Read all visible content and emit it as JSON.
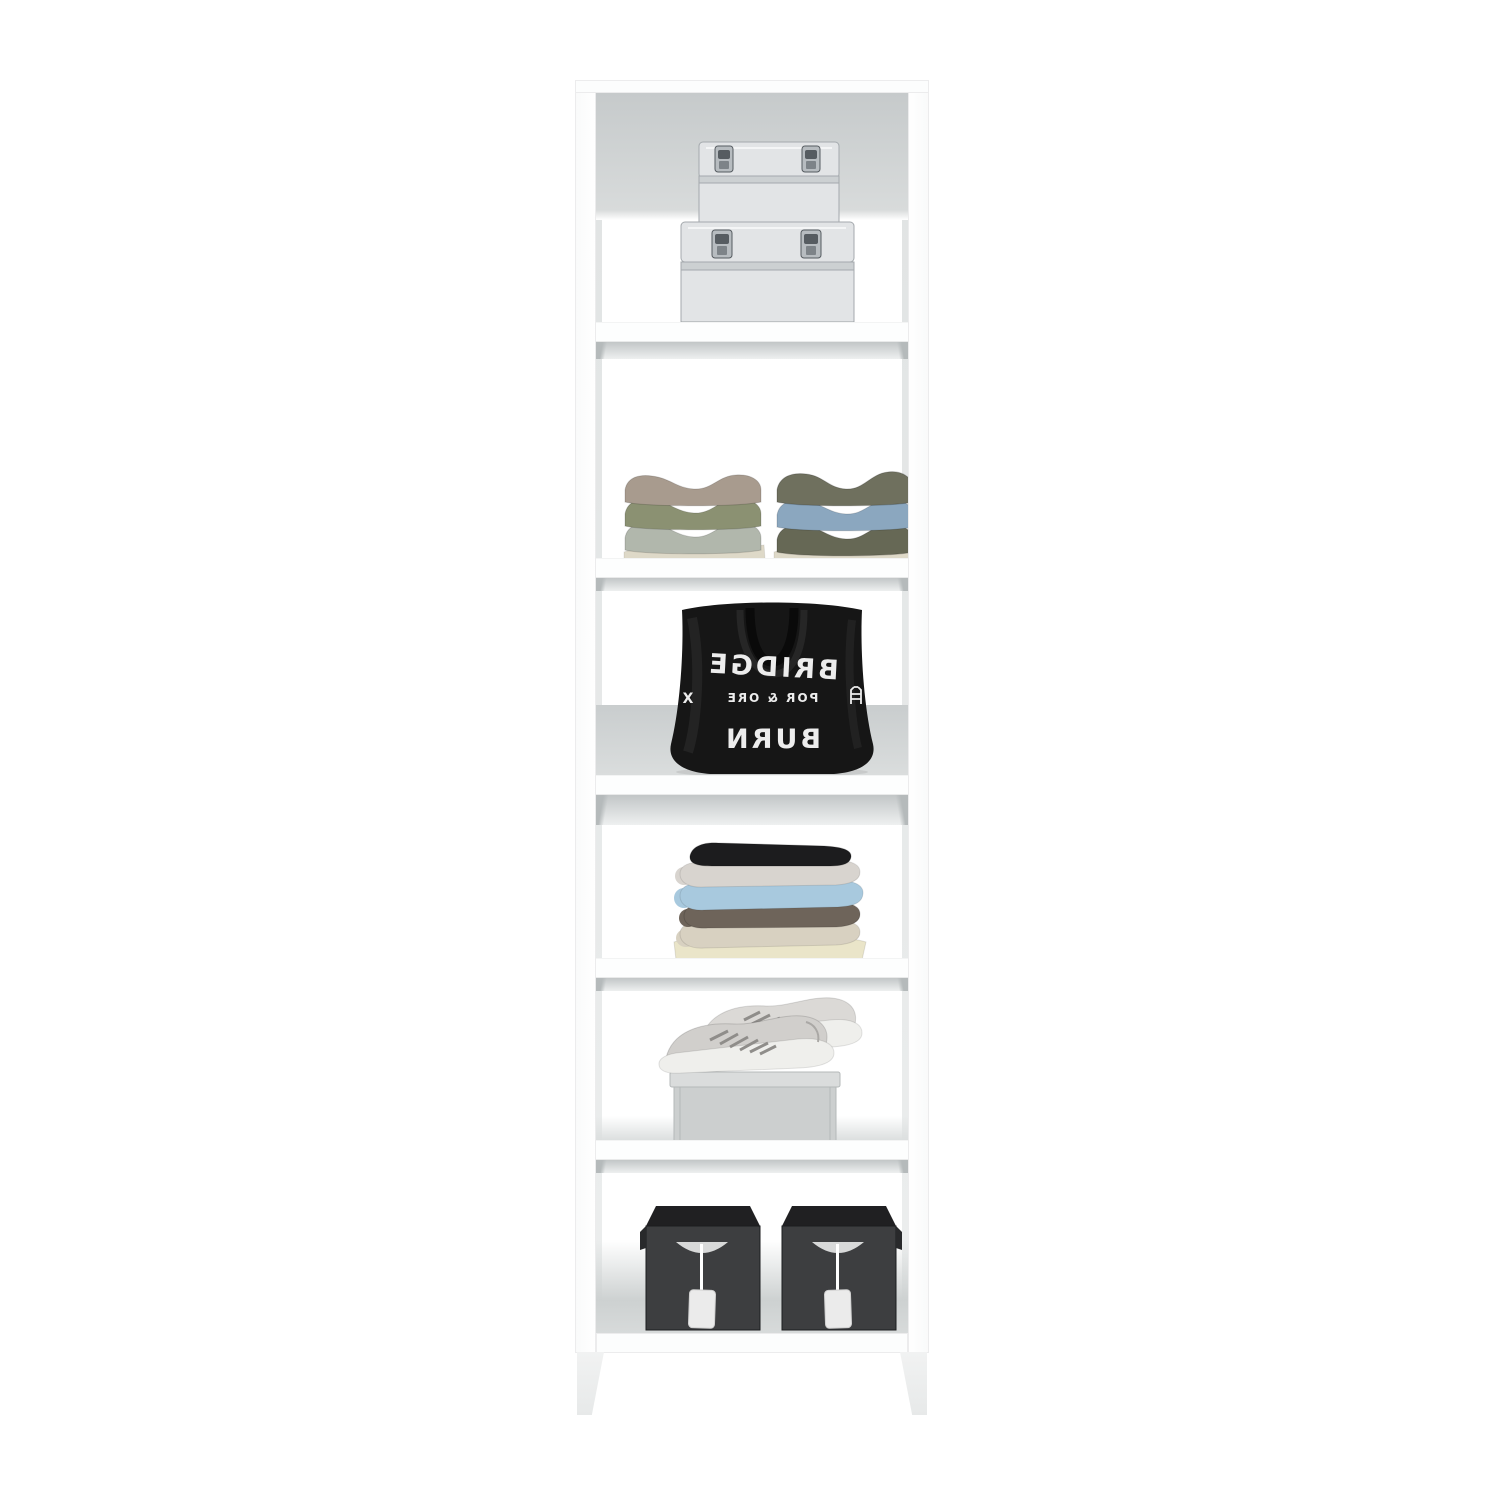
{
  "scene": {
    "background": "#ffffff",
    "subject": "white six-compartment closet tower, styled product photo",
    "compartment_count": 6,
    "leg_count": 2
  },
  "colors": {
    "frame_white": "#fdfdfd",
    "inner_face_gray": "#e7e9e9",
    "back_panel_gray": "#cdd1d2",
    "shelf_shadow_gray": "#c6cacb",
    "cases": {
      "shell": "#e2e4e6",
      "lip": "#ccd0d2",
      "outline": "#a4a9ad",
      "latch": "#b7bcc0",
      "latch_dark": "#565c61",
      "shadow": "#9aa0a3"
    },
    "sweaters_left": [
      "#a89b8e",
      "#8b9172",
      "#b1b7ac",
      "#ded9c8"
    ],
    "sweaters_right": [
      "#6f705e",
      "#8ba7bf",
      "#666855",
      "#ded9c8"
    ],
    "tote": {
      "body": "#161616",
      "handle": "#0a0a0a",
      "handle_front": "#262626",
      "print": "#ededed"
    },
    "clothes": [
      "#1c1c1e",
      "#d8d4cf",
      "#a8c9de",
      "#6e645a",
      "#d8d1c1",
      "#eae5c9"
    ],
    "sneakers": {
      "upper": "#d1cfcc",
      "upper_back": "#dbd9d6",
      "sole": "#efefec",
      "lace": "#8f8d8a"
    },
    "shoe_box": {
      "lid": "#dadcdc",
      "front": "#cccfcf",
      "edge": "#b4b8b9"
    },
    "bins": {
      "top": "#202022",
      "front": "#3d3e40",
      "edge": "#28292b",
      "hole": "#d8d9d9",
      "cord": "#ffffff",
      "tag": "#ebebeb"
    },
    "contact_shadow": "#000000"
  },
  "items": {
    "metal_cases": {
      "count": 2,
      "arrangement": "small case stacked on large case",
      "latches_per_case": 2
    },
    "sweater_stacks": {
      "stack_count": 2,
      "layers_per_stack": 3,
      "base_cloth": "cream folded shirt under each stack"
    },
    "tote_bag": {
      "print_mirrored": true,
      "line_top": "BRIDGE",
      "line_middle": "POR & ORE",
      "line_bottom": "BURN",
      "middle_left_mark": "X",
      "middle_right_mark": "bridge-tower-icon"
    },
    "clothes_stack": {
      "layer_count": 6
    },
    "sneakers": {
      "count": 2,
      "placement": "pair on shoe box"
    },
    "storage_bins": {
      "count": 2,
      "handle": "half-moon cutout",
      "tag": "white hang tag on cord"
    }
  }
}
